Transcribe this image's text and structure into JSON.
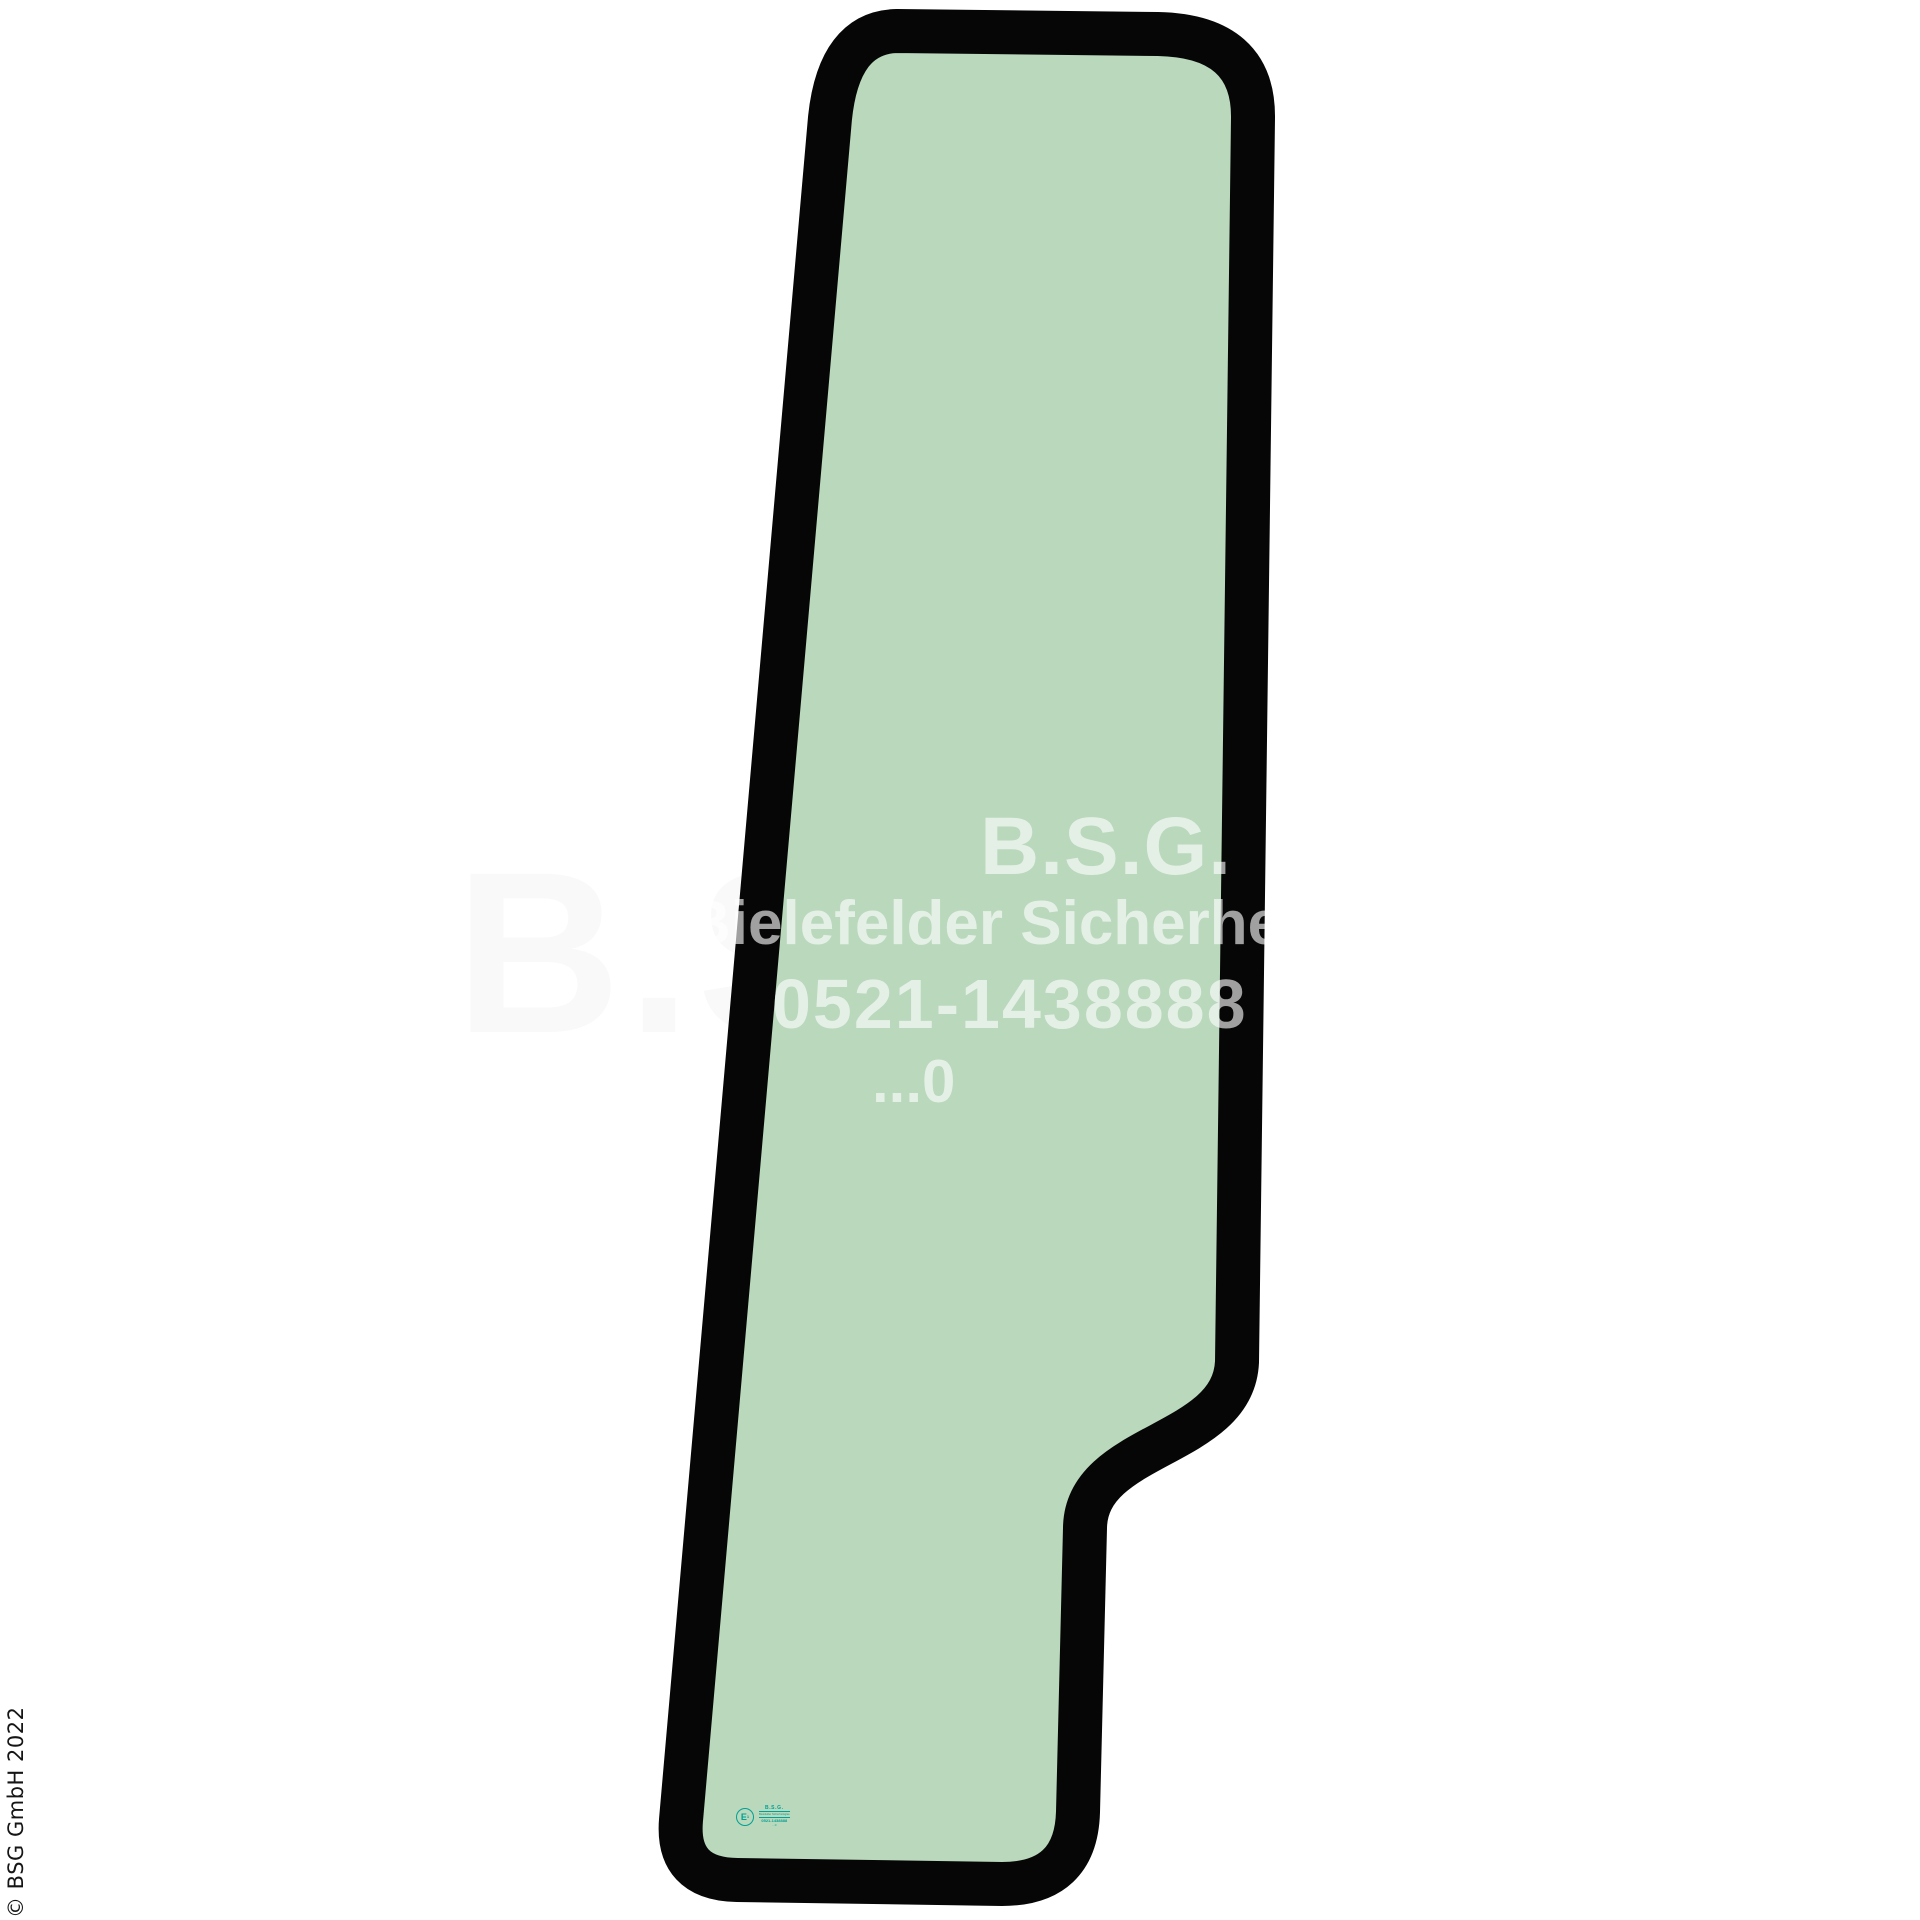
{
  "page": {
    "background_color": "#ffffff",
    "description": "Product image of a tapered cab door glass pane with black rubber-edge outline"
  },
  "glass": {
    "fill_color": "#b9d8bc",
    "border_color": "#060606"
  },
  "watermark": {
    "color": "#ffffff",
    "opacity": 0.62,
    "lines": [
      "B.S.G.",
      "Bielefelder Sicherheitsglas",
      "0521-1438888",
      "...0"
    ]
  },
  "stamp": {
    "color": "#00a095",
    "e_letter": "E",
    "e_number": "1",
    "lines": [
      "B.S.G.",
      "Bielefelder Sicherheitsglas",
      "0521-1438888",
      "...0"
    ]
  },
  "copyright": {
    "text": "© BSG GmbH 2022"
  }
}
